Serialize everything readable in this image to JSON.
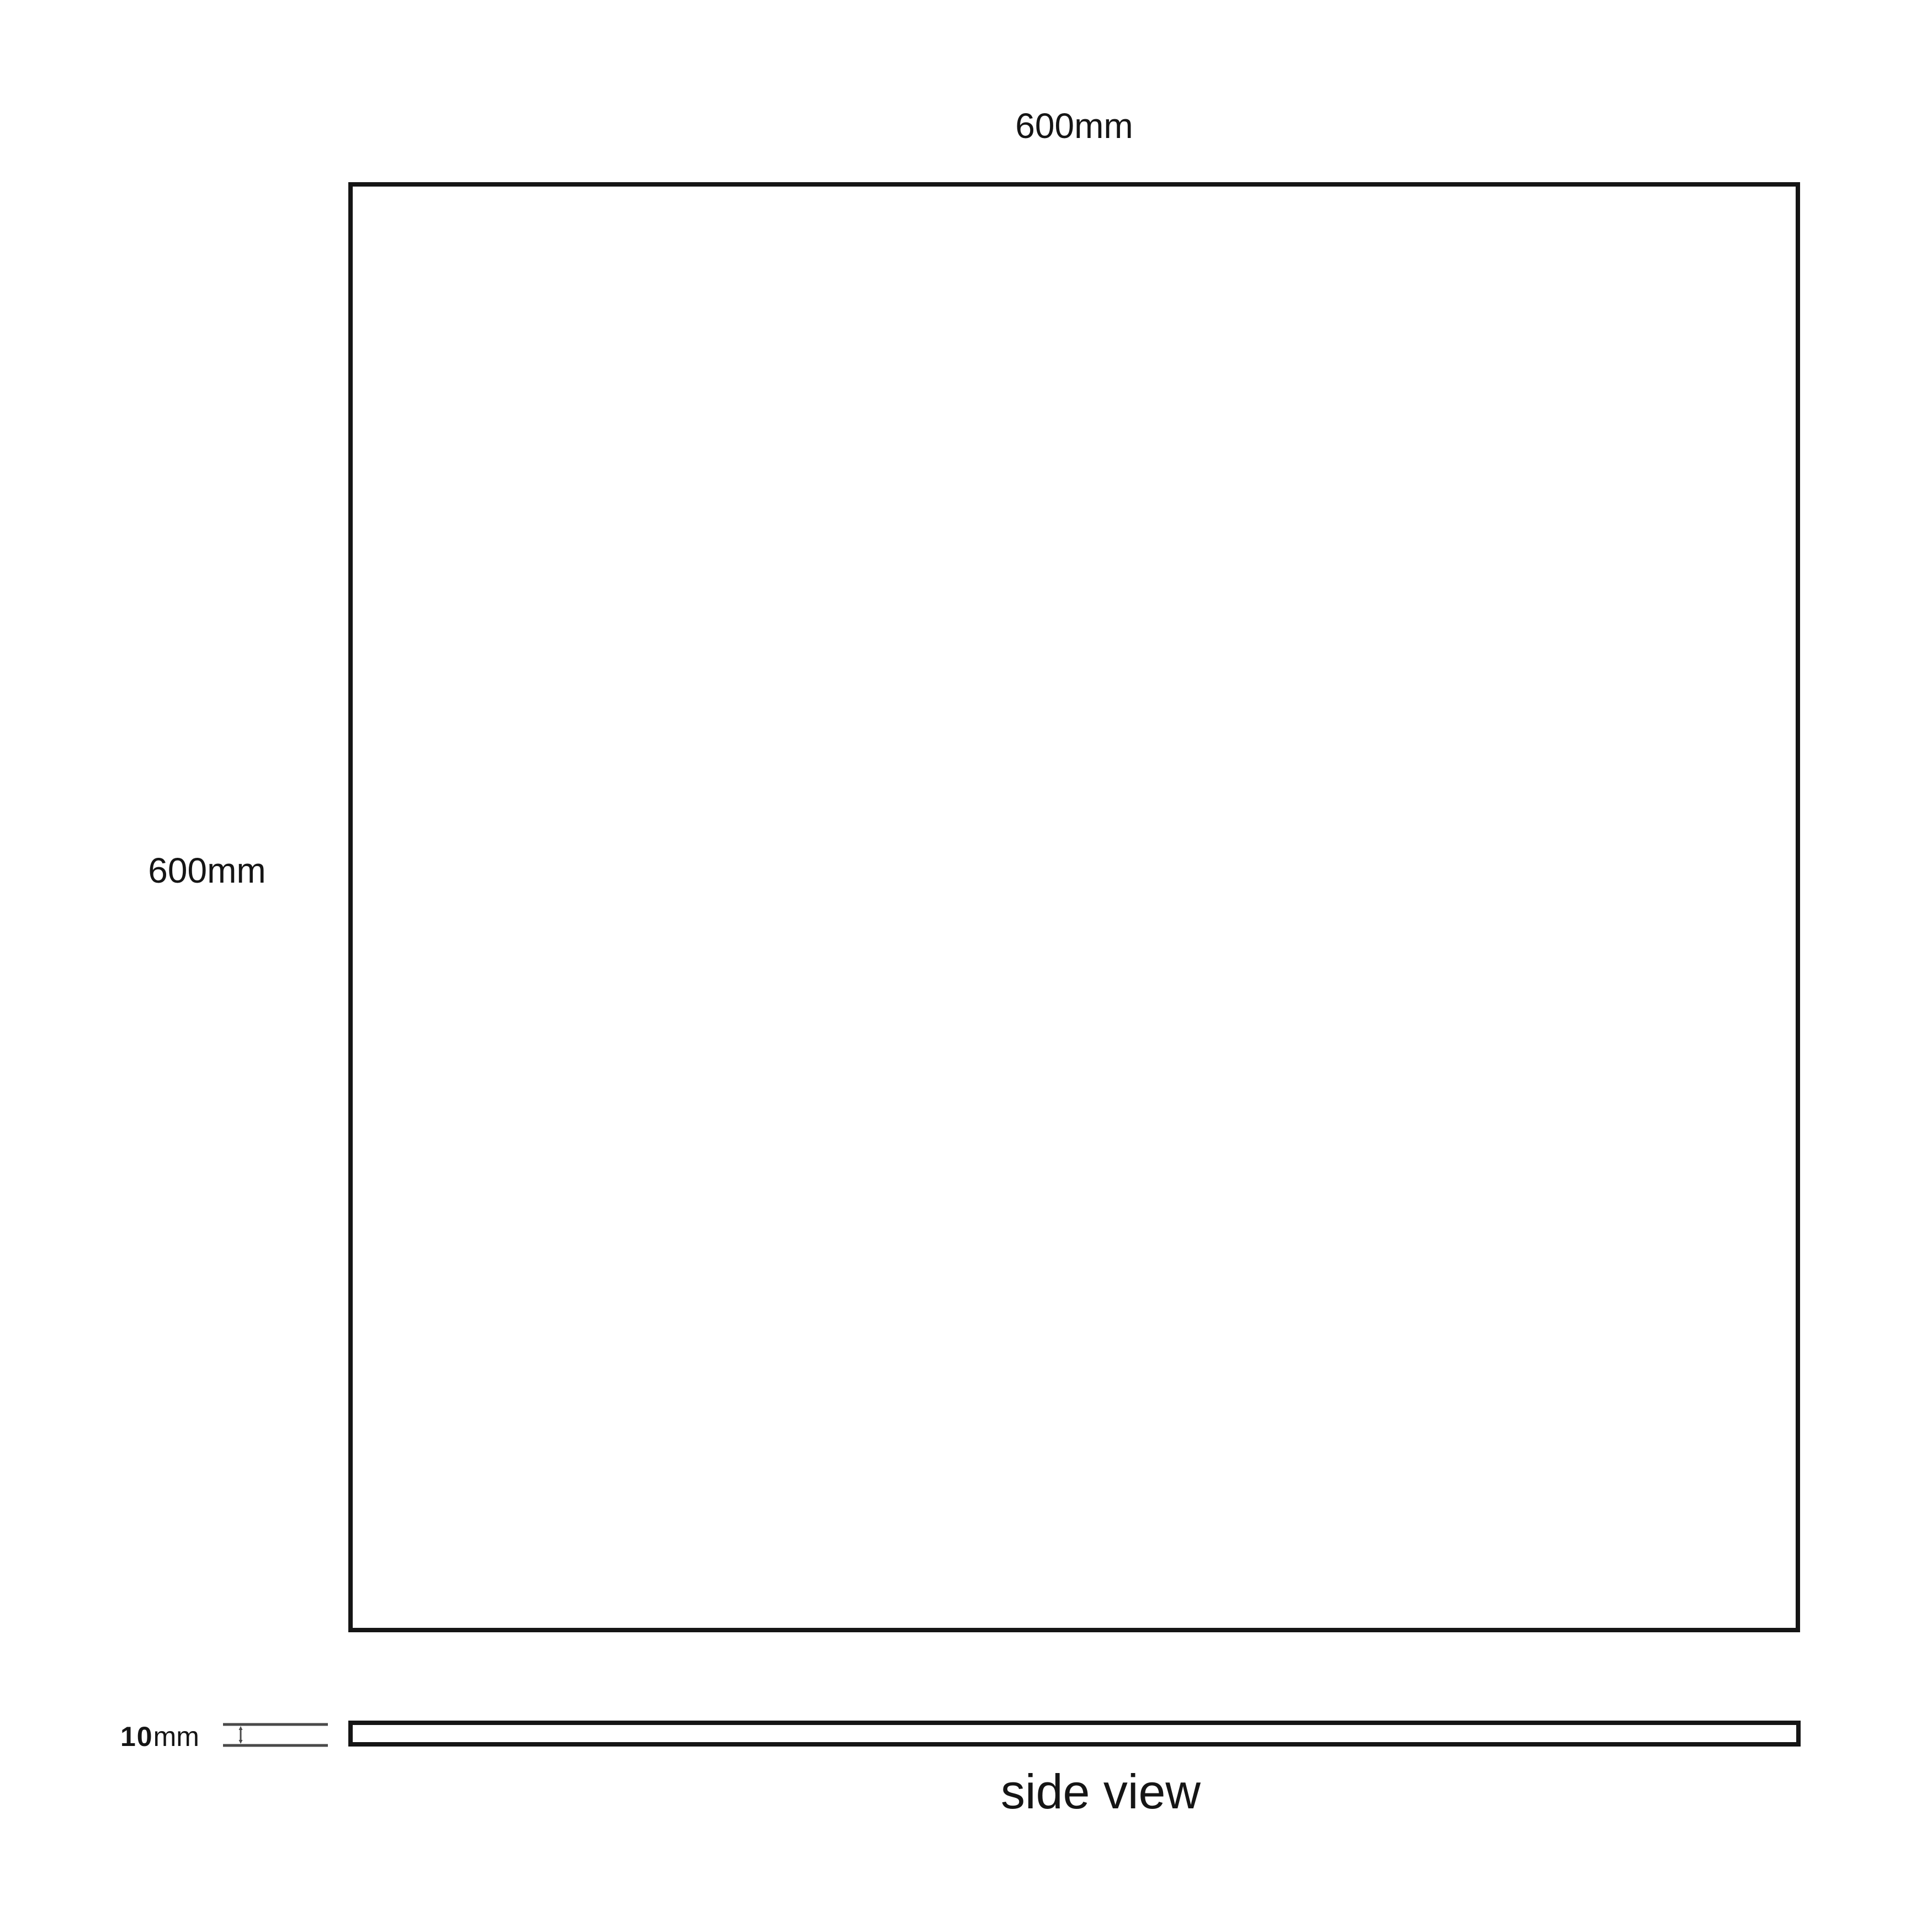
{
  "front_view": {
    "width_label": "600mm",
    "height_label": "600mm"
  },
  "side_view": {
    "thickness_value": "10",
    "thickness_unit": "mm",
    "caption": "side view"
  },
  "icons": {
    "thickness_marker": "dimension-extent-marker"
  },
  "colors": {
    "background": "#ffffff",
    "outline": "#151515",
    "dimension_marker": "#4a4a4a",
    "text": "#151515"
  }
}
